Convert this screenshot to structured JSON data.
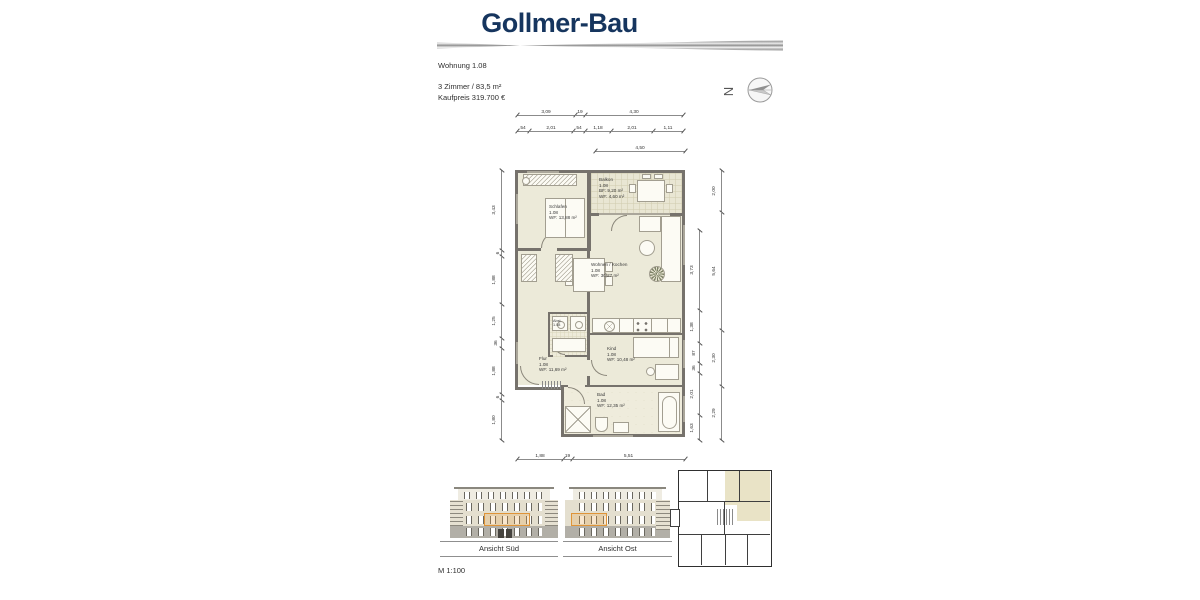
{
  "header": {
    "logo_text": "Gollmer-Bau"
  },
  "info": {
    "unit": "Wohnung 1.08",
    "details": "3 Zimmer   /   83,5 m²",
    "price": "Kaufpreis 319.700 €"
  },
  "compass": {
    "north_label": "N"
  },
  "plan": {
    "rooms": {
      "balkon": {
        "name": "Balkon",
        "nr": "1.08",
        "l1": "BF: 9,20 m²",
        "l2": "WF: 4,60 m²"
      },
      "schlafen": {
        "name": "Schlafen",
        "nr": "1.08",
        "l1": "WF: 13,88 m²"
      },
      "wohnen": {
        "name": "Wohnen / Kochen",
        "nr": "1.08",
        "l1": "WF:    30,27 m²"
      },
      "abst": {
        "name": "Abst.",
        "nr": "1.08"
      },
      "flur": {
        "name": "Flur",
        "nr": "1.08",
        "l1": "WF: 11,69 m²"
      },
      "kind": {
        "name": "Kind",
        "nr": "1.08",
        "l1": "WF: 10,48 m²"
      },
      "bad": {
        "name": "Bad",
        "nr": "1.08",
        "l1": "WF: 12,35 m²"
      }
    },
    "dims": {
      "top1": [
        "3,09",
        "19",
        "4,30"
      ],
      "top2": [
        "54",
        "2,01",
        "54",
        "1,18",
        "2,01",
        "1,11"
      ],
      "top3": [
        "4,50"
      ],
      "bottom": [
        "1,88",
        "19",
        "5,51"
      ],
      "left": [
        "3,43",
        "6",
        "1,88",
        "1,25",
        "36",
        "1,88",
        "6",
        "1,80"
      ],
      "right_inner": [
        "3,73",
        "1,38",
        "87",
        "36",
        "2,01",
        "1,63"
      ],
      "right_outer": [
        "2,00",
        "5,64",
        "2,30",
        "2,29"
      ]
    }
  },
  "elevations": {
    "sued": {
      "label": "Ansicht Süd"
    },
    "ost": {
      "label": "Ansicht Ost"
    }
  },
  "scale_note": "M 1:100",
  "colors": {
    "brand_navy": "#16355e",
    "highlight_orange": "#df9438",
    "wall_gray": "#76726c",
    "room_fill": "#ecead9",
    "facade_beige": "#e4dfcf"
  }
}
